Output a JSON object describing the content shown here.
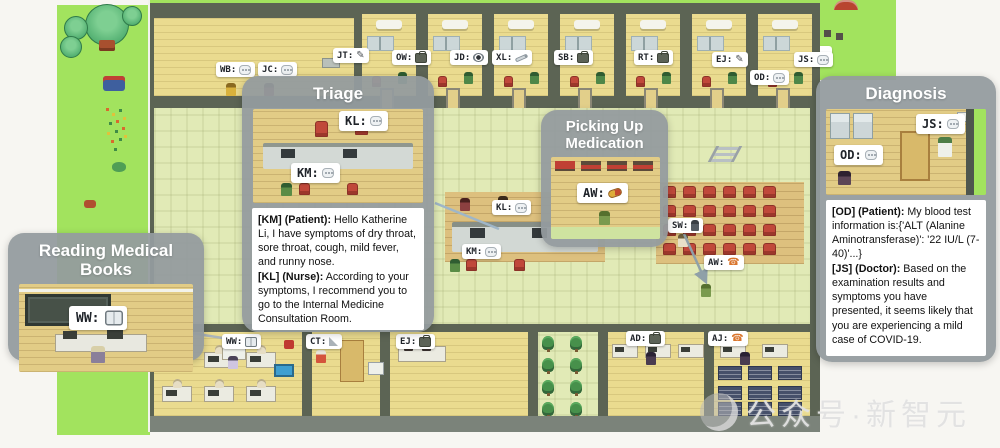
{
  "watermark": {
    "text": "公众号·新智元"
  },
  "callouts": {
    "reading": {
      "title": "Reading Medical Books",
      "tag": {
        "label": "WW:",
        "icon": "ic ic-book",
        "icon_name": "book-icon"
      }
    },
    "triage": {
      "title": "Triage",
      "tags": [
        {
          "label": "KL:",
          "icon": "ic ic-chat",
          "icon_name": "speech-bubble-icon"
        },
        {
          "label": "KM:",
          "icon": "ic ic-chat",
          "icon_name": "speech-bubble-icon"
        }
      ],
      "dialog": [
        {
          "speaker": "[KM] (Patient):",
          "text": " Hello Katherine Li, I have symptoms of dry throat, sore throat, cough, mild fever, and runny nose."
        },
        {
          "speaker": "[KL] (Nurse):",
          "text": " According to your symptoms, I recommend you to go to the Internal Medicine Consultation Room."
        }
      ]
    },
    "medication": {
      "title": "Picking Up Medication",
      "tag": {
        "label": "AW:",
        "icon": "ic ic-pill",
        "icon_name": "pill-icon"
      }
    },
    "diagnosis": {
      "title": "Diagnosis",
      "tags": [
        {
          "label": "JS:",
          "icon": "ic ic-chat",
          "icon_name": "speech-bubble-icon"
        },
        {
          "label": "OD:",
          "icon": "ic ic-chat",
          "icon_name": "speech-bubble-icon"
        }
      ],
      "dialog": [
        {
          "speaker": "[OD] (Patient):",
          "text": " My blood test information is:{'ALT (Alanine Aminotransferase)': '22 IU/L (7-40)'...}"
        },
        {
          "speaker": "[JS] (Doctor):",
          "text": " Based on the examination results and symptoms you have presented, it seems likely that you are experiencing a mild case of COVID-19."
        }
      ]
    }
  },
  "map_tags": [
    {
      "label": "WB:",
      "icon": "ic ic-chat",
      "icon_name": "speech-bubble-icon"
    },
    {
      "label": "JC:",
      "icon": "ic ic-chat",
      "icon_name": "speech-bubble-icon"
    },
    {
      "label": "JT:",
      "icon": "ic ic-pen",
      "icon_name": "pen-icon",
      "icon2": "ic ic2 ic-leaf",
      "icon2_name": "leaf-icon"
    },
    {
      "label": "OW:",
      "icon": "ic ic-case",
      "icon_name": "briefcase-icon",
      "icon2": "ic ic2 ic-leaf",
      "icon2_name": "leaf-icon"
    },
    {
      "label": "JD:",
      "icon": "ic ic-eye",
      "icon_name": "eye-icon"
    },
    {
      "label": "XL:",
      "icon": "ic ic-syringe",
      "icon_name": "syringe-icon"
    },
    {
      "label": "SB:",
      "icon": "ic ic-case",
      "icon_name": "briefcase-icon",
      "icon2": "ic ic2 ic-leaf",
      "icon2_name": "leaf-icon"
    },
    {
      "label": "RT:",
      "icon": "ic ic-case",
      "icon_name": "briefcase-icon",
      "icon2": "ic ic2 ic-leaf",
      "icon2_name": "leaf-icon"
    },
    {
      "label": "EJ:",
      "icon": "ic ic-pen",
      "icon_name": "pen-icon",
      "icon2": "ic ic2 ic-leaf",
      "icon2_name": "leaf-icon"
    },
    {
      "label": "JS:",
      "icon": "ic ic-chat",
      "icon_name": "speech-bubble-icon"
    },
    {
      "label": "OD:",
      "icon": "ic ic-chat",
      "icon_name": "speech-bubble-icon"
    },
    {
      "label": "KL:",
      "icon": "ic ic-chat",
      "icon_name": "speech-bubble-icon"
    },
    {
      "label": "KM:",
      "icon": "ic ic-chat",
      "icon_name": "speech-bubble-icon"
    },
    {
      "label": "SW:",
      "icon": "ic ic-person",
      "icon_name": "walking-person-icon"
    },
    {
      "label": "AW:",
      "icon": "ic ic-phone",
      "icon_name": "phone-icon"
    },
    {
      "label": "WW:",
      "icon": "ic ic-book",
      "icon_name": "book-icon"
    },
    {
      "label": "CT:",
      "icon": "ic ic-ruler",
      "icon_name": "set-square-icon",
      "icon2": "ic ic2 ic-case",
      "icon2_name": "briefcase-icon"
    },
    {
      "label": "EJ:",
      "icon": "ic ic-case",
      "icon_name": "briefcase-icon"
    },
    {
      "label": "AD:",
      "icon": "ic ic-case",
      "icon_name": "briefcase-icon"
    },
    {
      "label": "AJ:",
      "icon": "ic ic-phone",
      "icon_name": "phone-icon",
      "icon2": "ic ic2 ic-case",
      "icon2_name": "briefcase-icon"
    }
  ]
}
